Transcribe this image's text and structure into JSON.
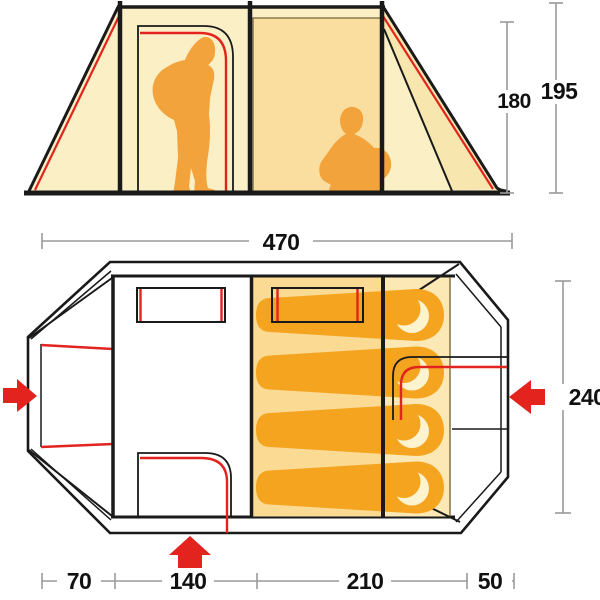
{
  "diagram": {
    "subject": "tent technical drawing",
    "views": [
      {
        "id": "side_elevation",
        "label": "side elevation view"
      },
      {
        "id": "floor_plan",
        "label": "floor plan view"
      }
    ]
  },
  "dims": {
    "elevation": {
      "inner_height": "180",
      "outer_height": "195"
    },
    "plan": {
      "length": "470",
      "width": "240",
      "segments": [
        "70",
        "140",
        "210",
        "50"
      ]
    }
  },
  "features": {
    "sleeping_bags": 4,
    "windows": 2,
    "persons": [
      "standing adult with backpack",
      "crouching adult with backpack"
    ],
    "entrance_arrows": [
      "left",
      "right",
      "bottom"
    ]
  },
  "colors": {
    "canvas_cream": "#FBEFC5",
    "inner_panel": "#F9DEA0",
    "sleeping_area": "#FBDB93",
    "right_strip": "#FCE8B4",
    "slope_wedge": "#F7E6AE",
    "bag_orange": "#F5A41F",
    "bag_hood_cream": "#FDF3CF",
    "person_orange": "#F2A33C",
    "accent_red": "#E2231E",
    "outline_black": "#1A1A1A",
    "dimension_gray": "#9A9A9A"
  }
}
